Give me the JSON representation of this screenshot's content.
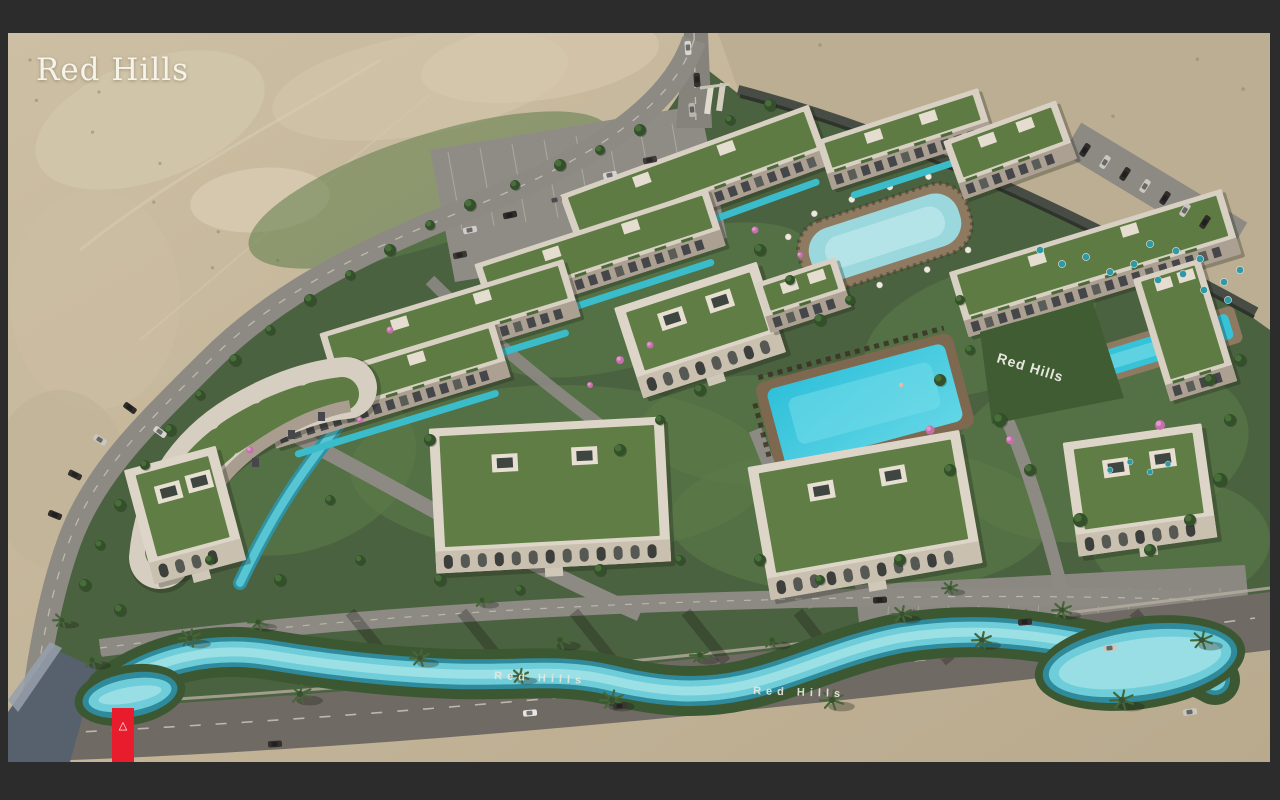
{
  "brand": {
    "logo_text": "Red Hills"
  },
  "signs": {
    "hillside": "Red Hills",
    "river_west": "Red Hills",
    "river_east": "Red Hills"
  },
  "marker": {
    "icon": "△",
    "color": "#e81c2c"
  },
  "palette": {
    "frame": "#2c2c2c",
    "desert": "#c6b79c",
    "greenery": "#4b6240",
    "pool": "#3ec5d8",
    "building": "#d8d1c3"
  }
}
